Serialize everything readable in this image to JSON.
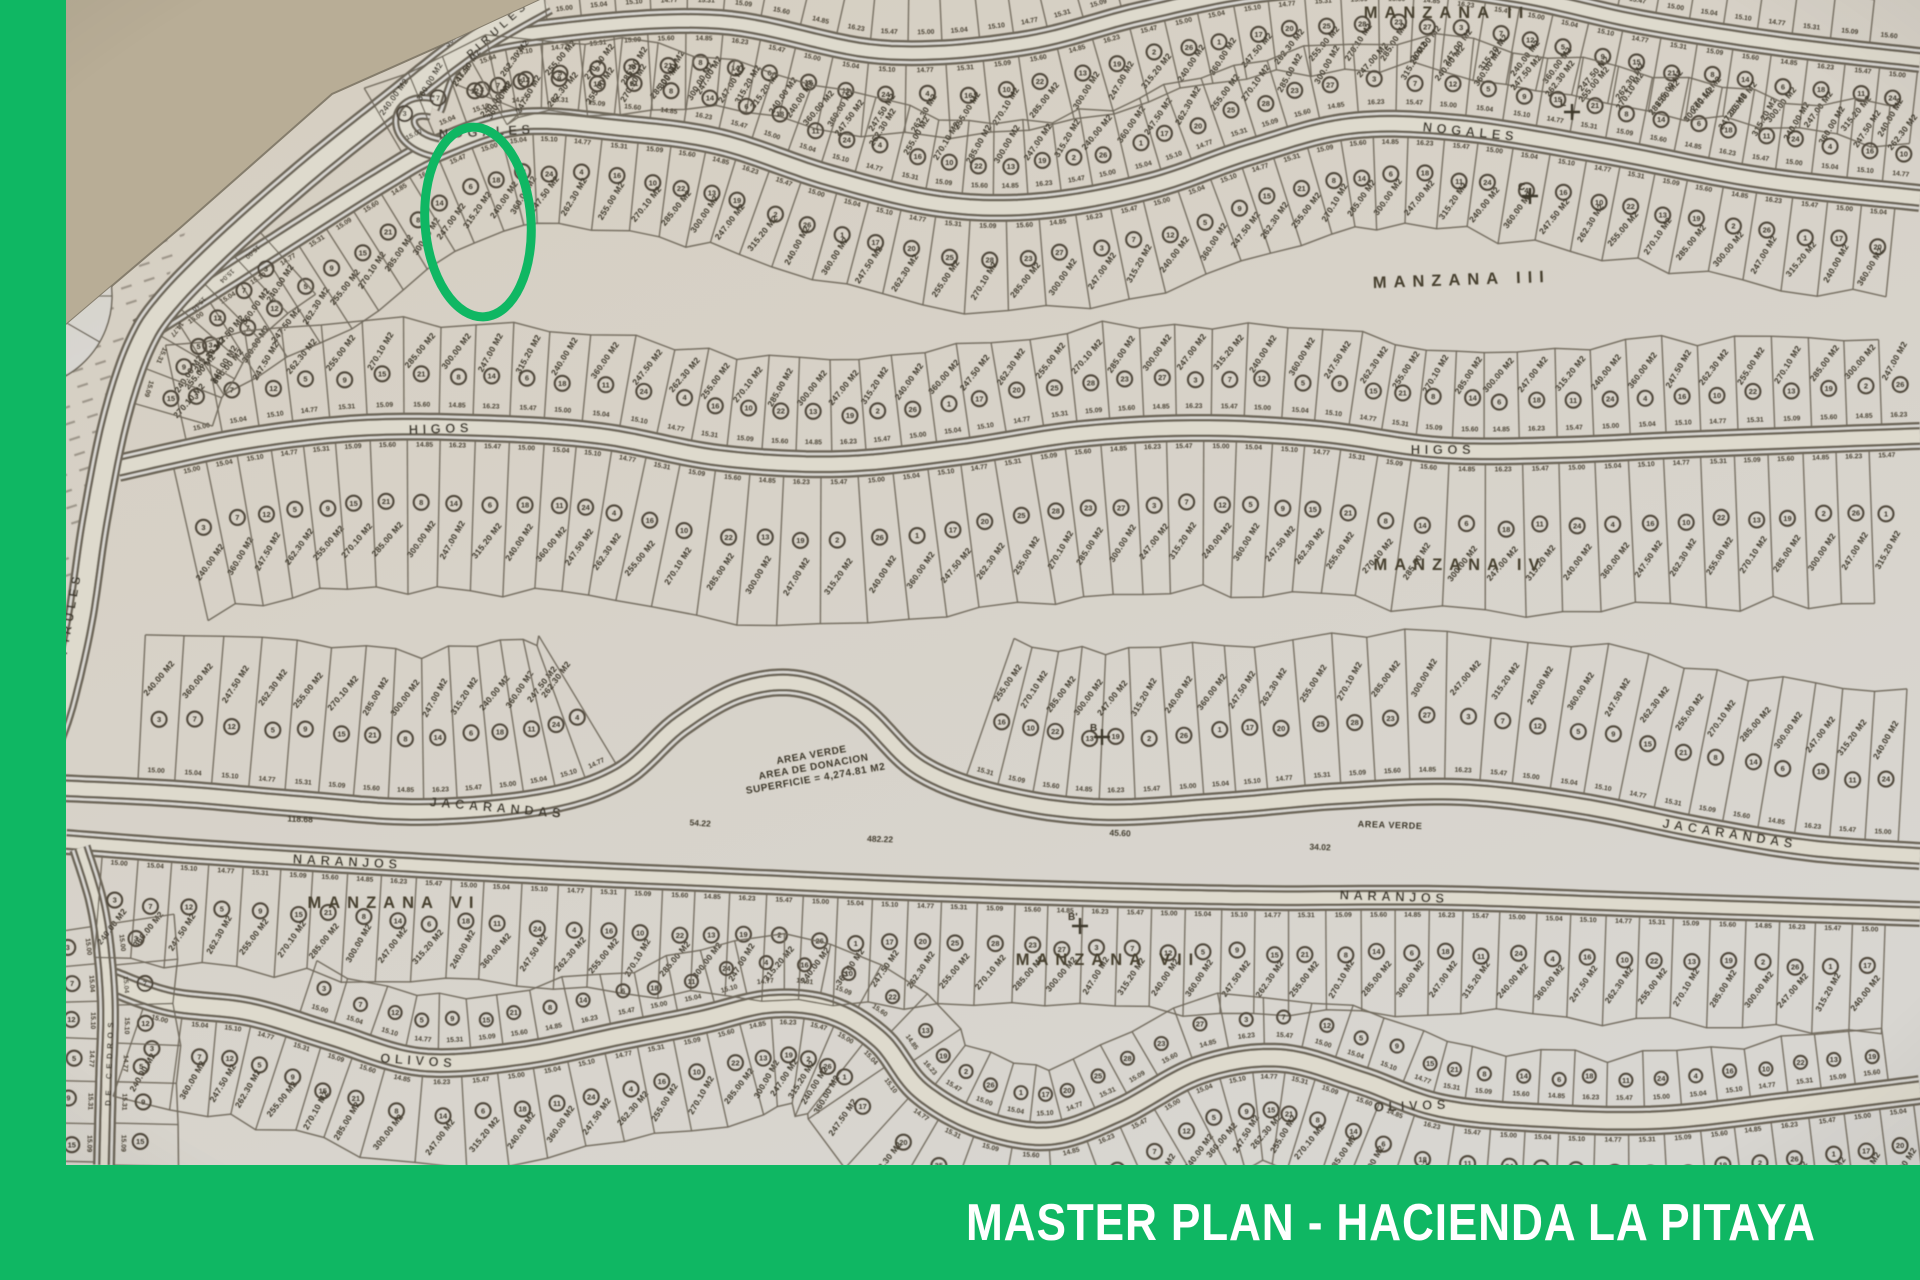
{
  "colors": {
    "green": "#0fb763",
    "banner_text": "#ffffff",
    "background_tan": "#b8ad96",
    "paper_warm": "#d6cec0",
    "paper_gray": "#d8d6d1",
    "road_fill": "#dedacd",
    "line": "#6e675a",
    "map_text": "#4a4335"
  },
  "banner": {
    "title": "MASTER PLAN - HACIENDA LA PITAYA"
  },
  "frame": {
    "left_bar": true
  },
  "annotation": {
    "highlight_ellipse": {
      "cx": 478,
      "cy": 222,
      "rx": 53,
      "ry": 95,
      "rot": -4,
      "stroke_w": 9
    }
  },
  "map": {
    "paper_polygon": "0,1280 0,402 60,330 180,228 332,94 458,38 540,0 1920,0 1920,1280",
    "paper_edge": "0,402 60,330 180,228 332,94 458,38 540,0",
    "streets": [
      {
        "id": "top",
        "name": "",
        "half": 10,
        "ctrl": [
          [
            432,
            108
          ],
          [
            462,
            52
          ],
          [
            560,
            30
          ],
          [
            720,
            22
          ],
          [
            880,
            52
          ],
          [
            1020,
            44
          ],
          [
            1140,
            14
          ],
          [
            1260,
            -10
          ],
          [
            1400,
            -18
          ],
          [
            1520,
            -4
          ],
          [
            1640,
            22
          ],
          [
            1780,
            44
          ],
          [
            1920,
            60
          ]
        ],
        "labels": []
      },
      {
        "id": "nogales",
        "name": "NOGALES",
        "half": 11,
        "ctrl": [
          [
            140,
            332
          ],
          [
            260,
            256
          ],
          [
            380,
            180
          ],
          [
            438,
            148
          ],
          [
            520,
            122
          ],
          [
            620,
            128
          ],
          [
            720,
            142
          ],
          [
            830,
            178
          ],
          [
            940,
            204
          ],
          [
            1040,
            206
          ],
          [
            1150,
            186
          ],
          [
            1250,
            152
          ],
          [
            1350,
            126
          ],
          [
            1460,
            128
          ],
          [
            1600,
            150
          ],
          [
            1760,
            180
          ],
          [
            1920,
            198
          ]
        ],
        "labels": [
          {
            "x": 487,
            "y": 136,
            "rot": -3,
            "size": 13
          },
          {
            "x": 1470,
            "y": 136,
            "rot": 6,
            "size": 13
          }
        ]
      },
      {
        "id": "higos",
        "name": "HIGOS",
        "half": 11,
        "ctrl": [
          [
            118,
            468
          ],
          [
            240,
            442
          ],
          [
            360,
            428
          ],
          [
            480,
            428
          ],
          [
            600,
            436
          ],
          [
            720,
            458
          ],
          [
            840,
            464
          ],
          [
            960,
            452
          ],
          [
            1080,
            434
          ],
          [
            1200,
            428
          ],
          [
            1320,
            434
          ],
          [
            1440,
            450
          ],
          [
            1560,
            450
          ],
          [
            1700,
            444
          ],
          [
            1920,
            436
          ]
        ],
        "labels": [
          {
            "x": 441,
            "y": 433,
            "rot": -2,
            "size": 13
          },
          {
            "x": 1443,
            "y": 454,
            "rot": 0,
            "size": 13
          }
        ]
      },
      {
        "id": "jacarandas",
        "name": "JACARANDAS",
        "half": 11,
        "ctrl": [
          [
            60,
            788
          ],
          [
            180,
            794
          ],
          [
            300,
            804
          ],
          [
            420,
            812
          ],
          [
            540,
            802
          ],
          [
            620,
            776
          ],
          [
            680,
            724
          ],
          [
            740,
            690
          ],
          [
            800,
            684
          ],
          [
            860,
            712
          ],
          [
            920,
            768
          ],
          [
            1000,
            798
          ],
          [
            1100,
            812
          ],
          [
            1220,
            806
          ],
          [
            1340,
            796
          ],
          [
            1460,
            792
          ],
          [
            1580,
            806
          ],
          [
            1700,
            830
          ],
          [
            1810,
            848
          ],
          [
            1920,
            856
          ]
        ],
        "labels": [
          {
            "x": 497,
            "y": 812,
            "rot": 5,
            "size": 13
          },
          {
            "x": 1729,
            "y": 838,
            "rot": 9,
            "size": 13
          }
        ]
      },
      {
        "id": "naranjos",
        "name": "NARANJOS",
        "half": 10,
        "ctrl": [
          [
            66,
            842
          ],
          [
            200,
            852
          ],
          [
            360,
            862
          ],
          [
            540,
            872
          ],
          [
            720,
            880
          ],
          [
            900,
            888
          ],
          [
            1080,
            894
          ],
          [
            1260,
            898
          ],
          [
            1440,
            898
          ],
          [
            1620,
            904
          ],
          [
            1920,
            914
          ]
        ],
        "labels": [
          {
            "x": 347,
            "y": 866,
            "rot": 3,
            "size": 13
          },
          {
            "x": 1394,
            "y": 901,
            "rot": 2,
            "size": 13
          }
        ]
      },
      {
        "id": "olivos",
        "name": "OLIVOS",
        "half": 12,
        "ctrl": [
          [
            112,
            982
          ],
          [
            170,
            1002
          ],
          [
            250,
            1012
          ],
          [
            330,
            1036
          ],
          [
            420,
            1062
          ],
          [
            520,
            1056
          ],
          [
            620,
            1036
          ],
          [
            700,
            1020
          ],
          [
            770,
            1004
          ],
          [
            830,
            1010
          ],
          [
            880,
            1040
          ],
          [
            920,
            1090
          ],
          [
            980,
            1124
          ],
          [
            1050,
            1136
          ],
          [
            1120,
            1112
          ],
          [
            1200,
            1070
          ],
          [
            1280,
            1058
          ],
          [
            1360,
            1080
          ],
          [
            1440,
            1108
          ],
          [
            1540,
            1118
          ],
          [
            1660,
            1120
          ],
          [
            1790,
            1106
          ],
          [
            1920,
            1090
          ]
        ],
        "labels": [
          {
            "x": 418,
            "y": 1065,
            "rot": 4,
            "size": 13
          },
          {
            "x": 1412,
            "y": 1110,
            "rot": -2,
            "size": 13
          }
        ]
      },
      {
        "id": "pirules",
        "name": "PIRULES",
        "half": 13,
        "ctrl": [
          [
            545,
            0
          ],
          [
            470,
            44
          ],
          [
            390,
            106
          ],
          [
            310,
            170
          ],
          [
            230,
            240
          ],
          [
            170,
            300
          ],
          [
            140,
            345
          ],
          [
            115,
            420
          ],
          [
            95,
            520
          ],
          [
            80,
            620
          ],
          [
            62,
            700
          ],
          [
            48,
            742
          ],
          [
            40,
            768
          ]
        ],
        "labels": [
          {
            "x": 74,
            "y": 614,
            "rot": -80,
            "size": 12
          },
          {
            "x": 500,
            "y": 32,
            "rot": -42,
            "size": 11
          }
        ]
      },
      {
        "id": "cedros",
        "name": "DE CEDROS",
        "half": 8,
        "ctrl": [
          [
            80,
            848
          ],
          [
            96,
            900
          ],
          [
            104,
            950
          ],
          [
            108,
            1010
          ],
          [
            106,
            1080
          ],
          [
            104,
            1165
          ]
        ],
        "labels": [
          {
            "x": 112,
            "y": 1062,
            "rot": -88,
            "size": 8
          }
        ]
      }
    ],
    "link_paths": [
      {
        "name": "nogales-hairpin",
        "d": "M 432,108 C 396,100 394,140 438,148",
        "half": 10
      }
    ],
    "bands": [
      {
        "road": "top",
        "side": 1,
        "depth": 74,
        "lotW": 37,
        "from": 0.02,
        "to": 1,
        "circles": true
      },
      {
        "road": "top",
        "side": -1,
        "depth": 46,
        "lotW": 37,
        "from": 0.1,
        "to": 0.98,
        "circles": false,
        "noArea": true
      },
      {
        "road": "nogales",
        "side": -1,
        "depth": 74,
        "lotW": 35,
        "from": 0.17,
        "to": 0.99,
        "circles": true
      },
      {
        "road": "nogales",
        "side": 1,
        "depth": 92,
        "lotW": 35,
        "from": 0.02,
        "to": 0.99,
        "circles": true
      },
      {
        "road": "higos",
        "side": -1,
        "depth": 92,
        "lotW": 35,
        "from": 0.04,
        "to": 0.99,
        "circles": true
      },
      {
        "road": "higos",
        "side": 1,
        "depth": 150,
        "lotW": 35,
        "from": 0.03,
        "to": 0.99,
        "circles": true
      },
      {
        "road": "jacarandas",
        "side": -1,
        "depth": 148,
        "lotW": 35,
        "from": 0.04,
        "to": 0.99,
        "circles": true,
        "skip": [
          [
            0.3,
            0.5
          ]
        ]
      },
      {
        "road": "naranjos",
        "side": 1,
        "depth": 105,
        "lotW": 35,
        "from": 0.02,
        "to": 0.99,
        "circles": true
      },
      {
        "road": "olivos",
        "side": -1,
        "depth": 52,
        "lotW": 36,
        "from": 0.1,
        "to": 0.99,
        "circles": true,
        "noArea": true
      },
      {
        "road": "olivos",
        "side": 1,
        "depth": 92,
        "lotW": 36,
        "from": 0.02,
        "to": 1,
        "circles": true
      },
      {
        "road": "pirules",
        "side": -1,
        "depth": 80,
        "lotW": 38,
        "from": 0.38,
        "to": 0.62,
        "circles": true
      },
      {
        "road": "cedros",
        "side": -1,
        "depth": 62,
        "lotW": 40,
        "from": 0.25,
        "to": 1,
        "circles": true,
        "noArea": true
      },
      {
        "road": "cedros",
        "side": 1,
        "depth": 62,
        "lotW": 40,
        "from": 0.25,
        "to": 1,
        "circles": true,
        "noArea": true
      }
    ],
    "manzana_labels": [
      {
        "text": "MANZANA II",
        "x": 1447,
        "y": 18,
        "rot": 0
      },
      {
        "text": "MANZANA III",
        "x": 1462,
        "y": 285,
        "rot": -2
      },
      {
        "text": "MANZANA IV",
        "x": 1460,
        "y": 570,
        "rot": 0
      },
      {
        "text": "MANZANA VI",
        "x": 394,
        "y": 908,
        "rot": 0
      },
      {
        "text": "MANZANA VII",
        "x": 1108,
        "y": 965,
        "rot": 0
      },
      {
        "text": "MANZANA V",
        "x": 16,
        "y": 1048,
        "rot": -90
      }
    ],
    "area_labels": [
      {
        "lines": [
          "AREA VERDE"
        ],
        "x": 163,
        "y": 210,
        "rot": -35,
        "size": 9
      },
      {
        "lines": [
          "AREA",
          "SUPERFICIE"
        ],
        "x": 424,
        "y": 30,
        "rot": -42,
        "size": 9
      },
      {
        "lines": [
          "AREA VERDE",
          "AREA DE DONACION",
          "SUPERFICIE = 4,274.81 M2"
        ],
        "x": 812,
        "y": 758,
        "rot": -10,
        "size": 10
      },
      {
        "lines": [
          "AREA VERDE"
        ],
        "x": 1390,
        "y": 828,
        "rot": 2,
        "size": 9
      }
    ],
    "edge_numbers": [
      {
        "text": "47.70",
        "x": 57,
        "y": 152,
        "rot": -50
      },
      {
        "text": "30.08",
        "x": 248,
        "y": 118,
        "rot": -42
      },
      {
        "text": "36.42",
        "x": 455,
        "y": 40,
        "rot": -44
      },
      {
        "text": "62.00",
        "x": 98,
        "y": 268,
        "rot": -62
      },
      {
        "text": "118.68",
        "x": 300,
        "y": 822,
        "rot": 2
      },
      {
        "text": "482.22",
        "x": 880,
        "y": 842,
        "rot": 2
      },
      {
        "text": "54.22",
        "x": 700,
        "y": 826,
        "rot": 4
      },
      {
        "text": "45.60",
        "x": 1120,
        "y": 836,
        "rot": 2
      },
      {
        "text": "34.02",
        "x": 1320,
        "y": 850,
        "rot": 2
      }
    ],
    "survey_marks": [
      {
        "x": 1572,
        "y": 112,
        "label": "L"
      },
      {
        "x": 1530,
        "y": 196,
        "label": "C"
      },
      {
        "x": 1102,
        "y": 737,
        "label": "B"
      },
      {
        "x": 1080,
        "y": 926,
        "label": "B'"
      }
    ],
    "culdesac": {
      "cx": 20,
      "cy": 296,
      "r_outer": 92,
      "r_ring": 38,
      "spokes": 12
    },
    "teardrop": {
      "cx": 44,
      "cy": 770,
      "r": 17
    },
    "hatch_regions": [
      "0,408 60,336 150,338 108,470 84,560 66,664 46,750 0,750",
      "0,170 150,140 205,180 160,300 60,336 0,408"
    ],
    "lot_texture": {
      "areas": [
        "240.00 M2",
        "360.00 M2",
        "247.50 M2",
        "262.30 M2",
        "255.00 M2",
        "270.10 M2",
        "285.00 M2",
        "300.00 M2",
        "247.00 M2",
        "315.20 M2"
      ],
      "frontages": [
        "15.00",
        "15.04",
        "15.10",
        "14.77",
        "15.31",
        "15.09",
        "15.60",
        "14.85",
        "16.23",
        "15.47"
      ],
      "numbers": [
        "3",
        "7",
        "12",
        "5",
        "9",
        "15",
        "21",
        "8",
        "14",
        "6",
        "18",
        "11",
        "24",
        "4",
        "16",
        "10",
        "22",
        "13",
        "19",
        "2",
        "26",
        "1",
        "17",
        "20",
        "25",
        "28",
        "23",
        "27"
      ]
    }
  }
}
